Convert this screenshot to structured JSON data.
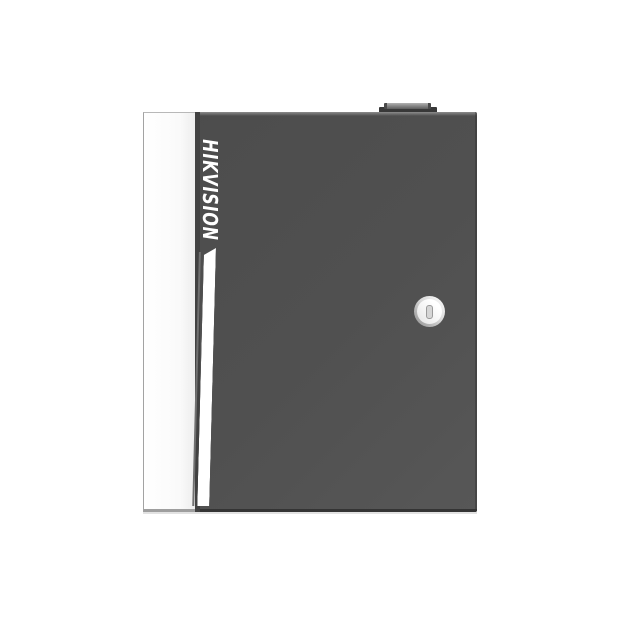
{
  "scene": {
    "type": "product-photo",
    "description": "Front view of a dark gray wall-mount metal enclosure (access controller cabinet) with a white left side strip, vertical HIKVISION logotype, white accent stripe, round key lock on the door and a small knob on the top edge",
    "background_color": "#ffffff"
  },
  "device": {
    "brand": "HIKVISION",
    "parts": {
      "cabinet": {
        "name": "enclosure-door",
        "color": "#505050"
      },
      "side_strip": {
        "name": "white-side-strip",
        "color": "#fafafa"
      },
      "accent_stripe": {
        "name": "white-accent-stripe",
        "color": "#ffffff"
      },
      "key_lock": {
        "name": "keyhole-lock",
        "ring_color": "#d9d9d9",
        "slot_color": "#d5d5d5"
      },
      "top_knob": {
        "name": "top-knob",
        "color": "#5c5c5c"
      }
    }
  }
}
